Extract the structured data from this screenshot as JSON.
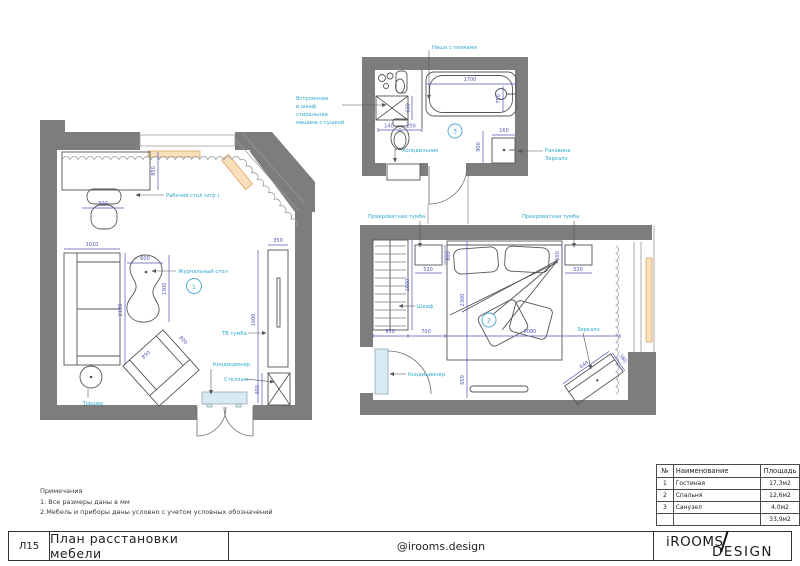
{
  "titlebar": {
    "sheet": "Л15",
    "title": "План расстановки мебели",
    "handle": "@irooms.design",
    "logo_line1": "iROOMS",
    "logo_slash": "/",
    "logo_line2": "DESIGN"
  },
  "notes": {
    "heading": "Примечания",
    "line1": "1. Все размеры даны в мм",
    "line2": "2.Мебель и приборы даны условно с учетом условных обозначений"
  },
  "area_table": {
    "col_num": "№",
    "col_name": "Наименование",
    "col_area": "Площадь",
    "rows": [
      [
        "1",
        "Гостиная",
        "17,3м2"
      ],
      [
        "2",
        "Спальня",
        "12,6м2"
      ],
      [
        "3",
        "Санузел",
        "4,0м2"
      ]
    ],
    "total_area": "33,9м2"
  },
  "living": {
    "marker": "1",
    "label_desk": "Рабочий стол (игр.)",
    "label_coffee_table": "Журнальный стол",
    "label_tv": "ТВ тумба",
    "label_ac": "Кондиционер",
    "label_shelf": "Стеллаж",
    "label_lamp": "Торшер",
    "dim_chair": "500",
    "dim_desk": "850",
    "dim_sofa_width": "1010",
    "dim_sofa_length": "2120",
    "dim_table_width": "600",
    "dim_table_length": "1300",
    "dim_armchair_width": "800",
    "dim_armchair_depth": "850",
    "dim_tv_stand": "350",
    "dim_tv_wall": "1600",
    "dim_shelf": "400"
  },
  "bath": {
    "marker": "3",
    "label_niche": "Ниша с полками",
    "label_washer_l1": "Встроенная",
    "label_washer_l2": "в шкаф",
    "label_washer_l3": "стиральная",
    "label_washer_l4": "машина с сушкой",
    "label_fridge": "Холодильник",
    "label_sink": "Раковина",
    "label_mirror": "Зеркало",
    "dim_tub_length": "1700",
    "dim_tub_width": "750",
    "dim_washer": "600",
    "dim_wc_1": "140",
    "dim_wc_2": "200",
    "dim_sink_wall": "900",
    "dim_sink": "160"
  },
  "bed": {
    "marker": "2",
    "label_nightstand_left": "Прикроватная тумба",
    "label_nightstand_right": "Прикроватная тумба",
    "label_wardrobe": "Шкаф",
    "label_ac": "Кондиционер",
    "label_mirror": "Зеркало",
    "dim_nightstand_left_w": "520",
    "dim_nightstand_left_d": "600",
    "dim_nightstand_right_w": "520",
    "dim_nightstand_right_d": "600",
    "dim_wardrobe_length": "1600",
    "dim_wardrobe": "950",
    "dim_gap": "700",
    "dim_bed_zone": "2080",
    "dim_bed_length": "2300",
    "dim_bed_foot": "650",
    "dim_mirror_w": "640",
    "dim_mirror_d": "360"
  },
  "colors": {
    "wall": "#7d7d7d",
    "dimension": "#5158b8",
    "annotation": "#2ea8cc",
    "window": "#e8a25f",
    "marker": "#45a9d2",
    "ac_fill": "#d9e9f1"
  }
}
